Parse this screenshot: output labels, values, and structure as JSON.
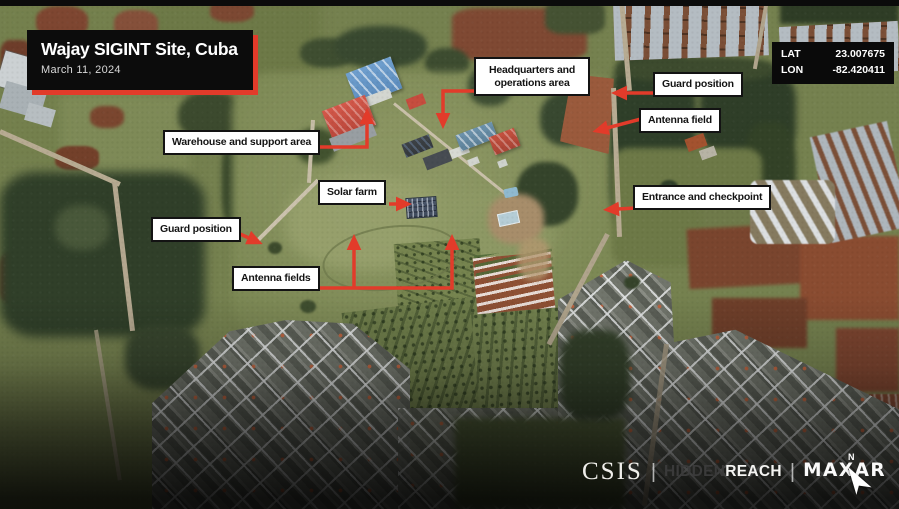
{
  "title_card": {
    "title": "Wajay SIGINT Site, Cuba",
    "date": "March 11, 2024"
  },
  "coordinates": {
    "lat_label": "LAT",
    "lat_value": "23.007675",
    "lon_label": "LON",
    "lon_value": "-82.420411"
  },
  "annotations": {
    "headquarters": "Headquarters and operations area",
    "guard_position_ne": "Guard position",
    "antenna_field": "Antenna field",
    "warehouse": "Warehouse and support area",
    "solar_farm": "Solar farm",
    "entrance": "Entrance and checkpoint",
    "guard_position_w": "Guard position",
    "antenna_fields": "Antenna fields"
  },
  "footer": {
    "csis": "CSIS",
    "hidden": "HIDDEN",
    "reach": "REACH",
    "maxar": "MAXAR",
    "separator": "|",
    "north_label": "N"
  },
  "colors": {
    "accent_red": "#e23b2a",
    "label_bg": "#ffffff",
    "label_text": "#131313",
    "card_bg": "#0c0c0c"
  }
}
